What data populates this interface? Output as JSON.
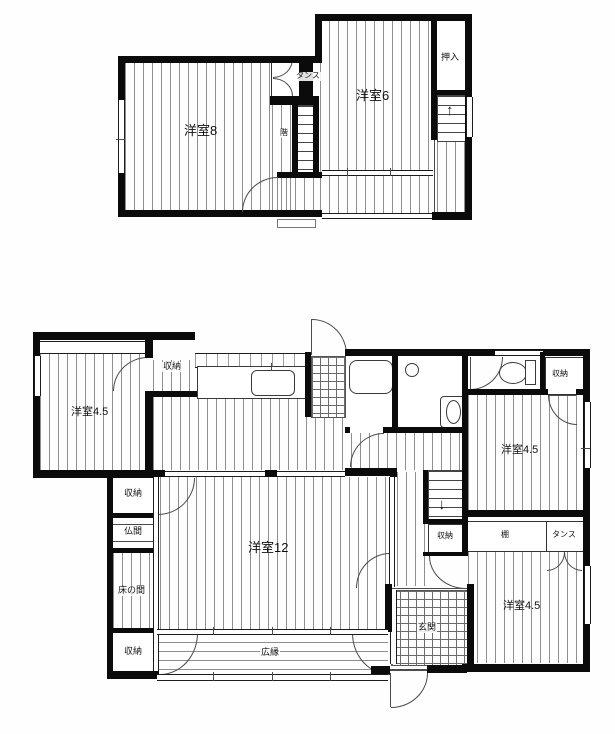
{
  "colors": {
    "wall": "#0b0b0b",
    "hatch_line": "#8f8f8f",
    "background": "#fefefe"
  },
  "icons": {
    "up_arrow": "↑",
    "down_arrow": "↓"
  },
  "f2": {
    "room8": "洋室8",
    "room6": "洋室6",
    "tansu": "タンス",
    "oshiire": "押入",
    "stair": "階"
  },
  "f1": {
    "room_nw": "洋室4.5",
    "closet_nw": "収納",
    "closet_w": "収納",
    "butsuma": "仏間",
    "tokonoma": "床の間",
    "closet_sw": "収納",
    "room12": "洋室12",
    "hiroen": "広縁",
    "genkan": "玄関",
    "closet_stair": "収納",
    "tana": "棚",
    "tansu": "タンス",
    "room_e": "洋室4.5",
    "room_se": "洋室4.5",
    "closet_ne": "収納"
  }
}
